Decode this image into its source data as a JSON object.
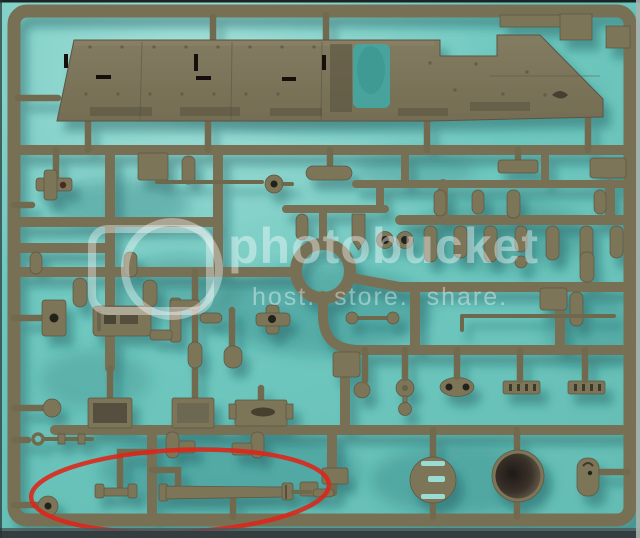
{
  "scene": {
    "subject": "olive-drab injection-molded model kit sprue photographed on a teal background",
    "background_color": "#6fc8bf",
    "plastic_color": "#7b7459",
    "shadow_color": "#155257",
    "bottom_edge_color": "#343d40"
  },
  "watermark": {
    "logo_icon": "photobucket-logo",
    "title": "photobucket",
    "tagline": "host. store. share.",
    "color": "#ffffff"
  },
  "annotation": {
    "shape": "ellipse",
    "color": "#de2418",
    "highlights": "long gun-barrel part and small parts at bottom left of sprue"
  }
}
